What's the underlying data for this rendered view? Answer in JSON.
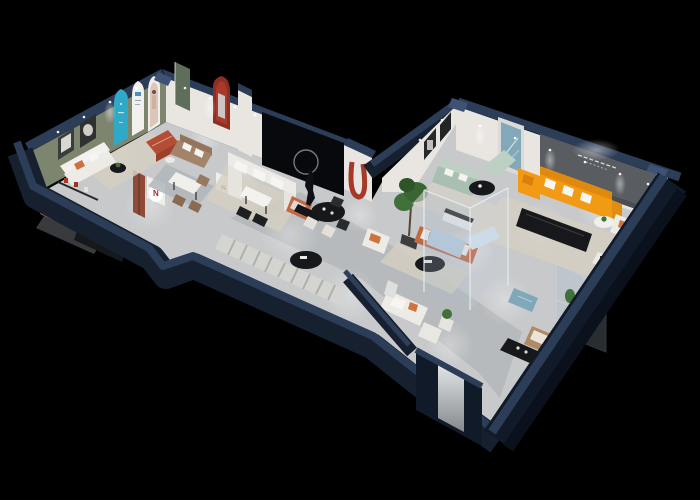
{
  "canvas": {
    "width": 700,
    "height": 500
  },
  "scene": {
    "type": "3d-isometric-cutaway-floorplan",
    "description": "Isometric 3D cutaway render of a furniture showroom floor plan with dark navy exterior walls on a black background",
    "wall_sign": {
      "lines_visible": 2,
      "legible": false
    },
    "poster_logo_letter": "N"
  },
  "palette": {
    "background": "#000000",
    "wall_navy": "#16202f",
    "wall_navy_dark": "#111a29",
    "wall_cap": "#2c3d58",
    "wall_cap_bright": "#3d5274",
    "wall_white": "#e9e6e1",
    "wall_white_dim": "#d8d5cf",
    "wall_olive": "#7d856f",
    "wall_dark_panel": "#595d61",
    "door_sage": "#5f6e5a",
    "accent_teal": "#2fa9c7",
    "accent_red": "#a53a2b",
    "red_dark": "#8e2f23",
    "floor_light": "#c7c9cb",
    "floor_mid": "#aaadb1",
    "rug_beige": "#d5cfc2",
    "rug_gray_blue": "#b0b6bb",
    "rug_runner": "#d4d5d1",
    "rug_dark": "#70747a",
    "sofa_white": "#edebe6",
    "sofa_tan": "#a3836a",
    "sofa_mint": "#a9bfb0",
    "mint_light": "#bed0c4",
    "sofa_orange": "#f29a14",
    "orange_shade": "#df8a0f",
    "sofa_terracotta": "#bf6a44",
    "pillow_orange": "#cc7340",
    "ottoman_red": "#b54d34",
    "ottoman_blue": "#7fa8ba",
    "chair_tan": "#b08a66",
    "bed_cognac": "#ad6a41",
    "sofa_blue": "#b9cbdc",
    "blue_light": "#cddbe8",
    "glass_tint": "#a9bdcc",
    "glass_edge": "#e6eef5",
    "plant_green": "#41703a",
    "plant_dark": "#2f5429",
    "furniture_black": "#17181b",
    "statue_black": "#0f1013",
    "artwork_teal": "#82a9b9",
    "bear_brown": "#7b4b35",
    "logo_red": "#a23227",
    "pillar_rust": "#8f4a38",
    "mirror_light": "#dfe1e3",
    "mirror_dark": "#8d9194"
  }
}
